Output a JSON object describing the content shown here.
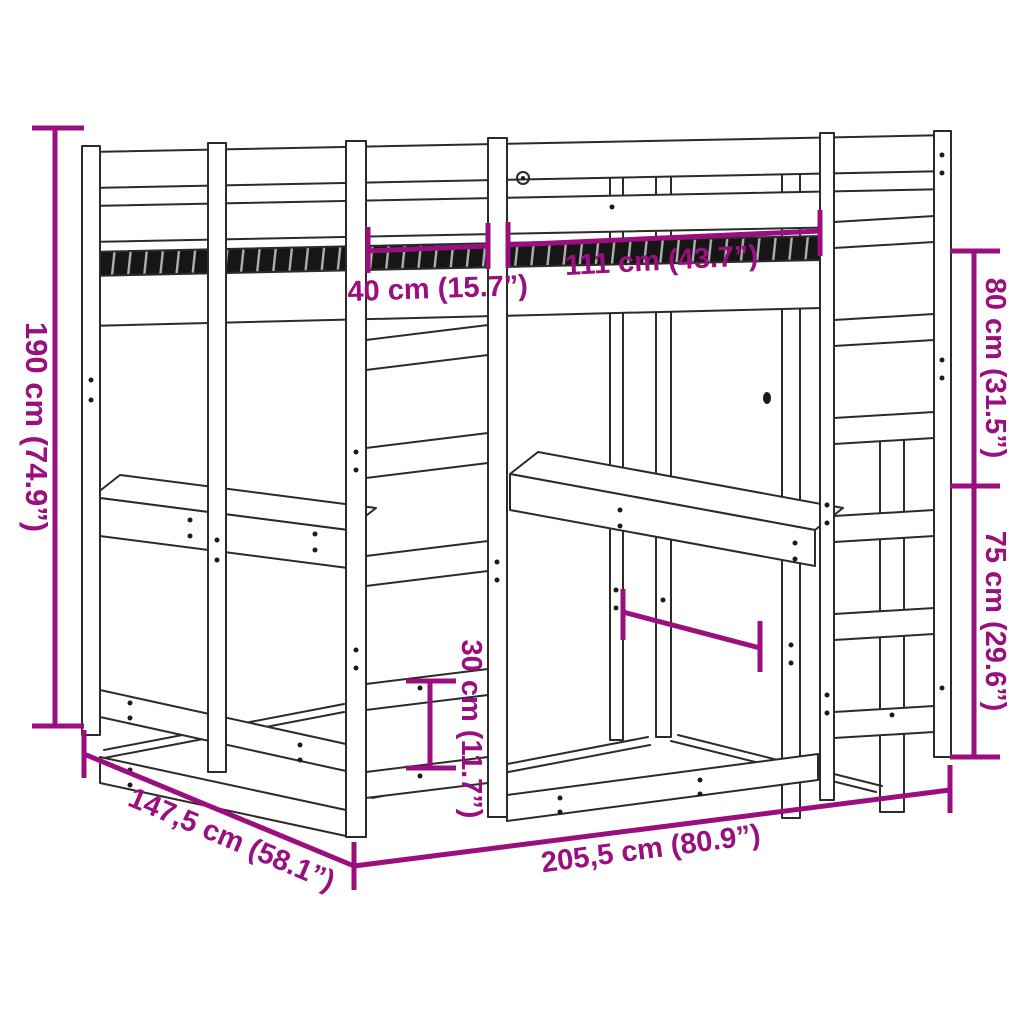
{
  "diagram": {
    "background_color": "#ffffff",
    "line_color": "#2b2b2b",
    "dimension_color": "#9b0e7e",
    "labels": {
      "total_height": "190 cm (74.9”)",
      "shelf_width": "40 cm (15.7”)",
      "bed_width": "111 cm (43.7”)",
      "upper_right_height": "80 cm (31.5”)",
      "lower_right_height": "75 cm (29.6”)",
      "shelf_gap": "30 cm (11.7”)",
      "total_depth": "147,5 cm (58.1”)",
      "total_width": "205,5 cm (80.9”)"
    }
  }
}
